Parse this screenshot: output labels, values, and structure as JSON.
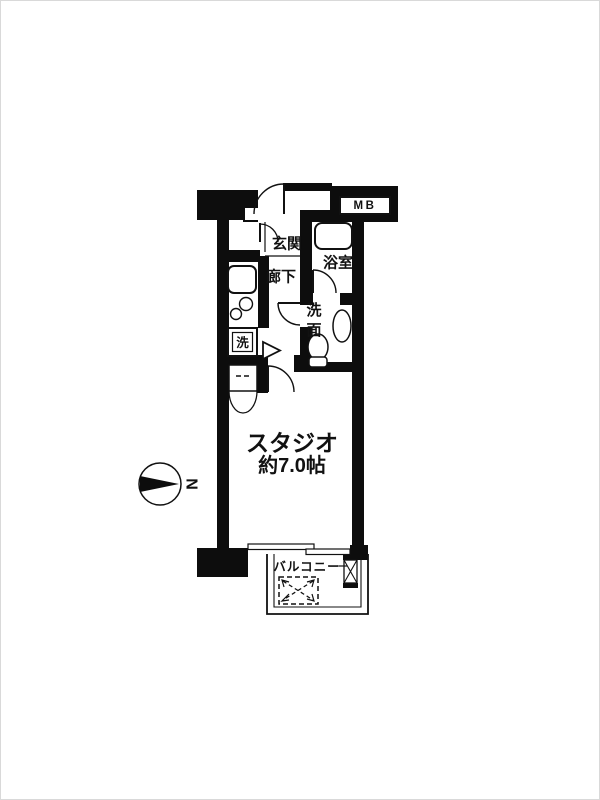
{
  "page": {
    "background": "#ffffff",
    "wall_color": "#0d0d0d",
    "line_color": "#111111"
  },
  "floor_plan": {
    "unit_type": "studio-apartment",
    "labels": {
      "meter_box": "MB",
      "entrance": "玄関",
      "hallway": "廊下",
      "bathroom": "浴室",
      "washroom": "洗面",
      "washing_machine": "洗",
      "room_name": "スタジオ",
      "room_size": "約7.0帖",
      "balcony": "バルコニー",
      "compass_north": "N"
    },
    "compass": {
      "label": "N",
      "points": "right"
    },
    "fixtures": [
      "bathtub",
      "toilet",
      "wash-basin",
      "kitchen-sink",
      "gas-burners",
      "washing-machine-space",
      "closet",
      "evacuation-hatch",
      "pipe-duct"
    ],
    "doors": [
      "entrance-door",
      "entrance-inner-door",
      "bathroom-door",
      "washroom-door",
      "studio-door",
      "closet-bifold-door"
    ],
    "windows": [
      "balcony-sliding-window"
    ]
  }
}
